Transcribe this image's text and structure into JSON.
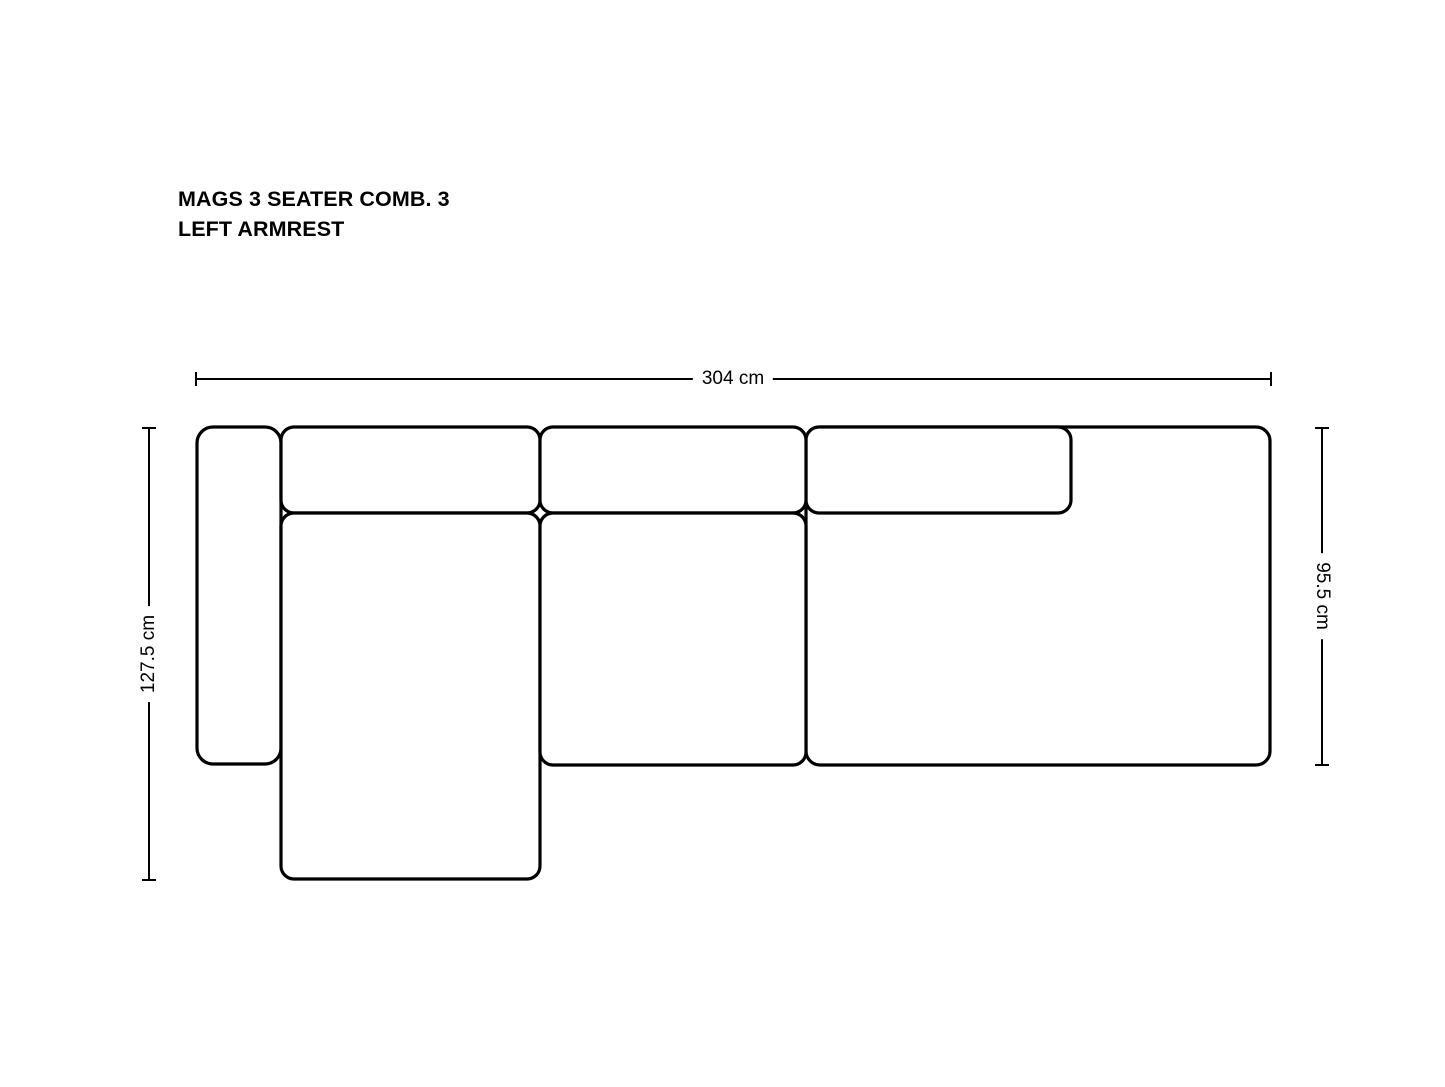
{
  "title": {
    "line1": "MAGS 3 SEATER COMB. 3",
    "line2": "LEFT ARMREST"
  },
  "dimensions": {
    "width": {
      "label": "304 cm",
      "value_cm": 304
    },
    "height_left": {
      "label": "127.5 cm",
      "value_cm": 127.5
    },
    "depth_right": {
      "label": "95.5 cm",
      "value_cm": 95.5
    }
  },
  "colors": {
    "line": "#000000",
    "text": "#000000",
    "background": "#ffffff"
  },
  "diagram": {
    "module_stroke_width": 3.2,
    "dim_stroke_width": 2,
    "modules": [
      {
        "name": "right-seat-module",
        "x": 806,
        "y": 427,
        "w": 464,
        "h": 338,
        "r": 14
      },
      {
        "name": "backrest-cushion-right",
        "x": 806,
        "y": 427,
        "w": 265,
        "h": 86,
        "r": 13
      },
      {
        "name": "left-armrest",
        "x": 197,
        "y": 427,
        "w": 84,
        "h": 337,
        "r": 16
      },
      {
        "name": "backrest-cushion-left",
        "x": 281,
        "y": 427,
        "w": 259,
        "h": 86,
        "r": 13
      },
      {
        "name": "backrest-cushion-middle",
        "x": 540,
        "y": 427,
        "w": 266,
        "h": 86,
        "r": 13
      },
      {
        "name": "chaise-lounge-seat",
        "x": 281,
        "y": 513,
        "w": 259,
        "h": 366,
        "r": 13
      },
      {
        "name": "middle-seat",
        "x": 540,
        "y": 513,
        "w": 266,
        "h": 252,
        "r": 13
      }
    ],
    "dimension_lines": [
      {
        "name": "width-dimension-line",
        "x1": 196,
        "y1": 379,
        "x2": 1271,
        "y2": 379,
        "tick": 14
      },
      {
        "name": "height-dimension-line",
        "x1": 149,
        "y1": 428,
        "x2": 149,
        "y2": 880,
        "tick": 14
      },
      {
        "name": "depth-dimension-line",
        "x1": 1322,
        "y1": 428,
        "x2": 1322,
        "y2": 765,
        "tick": 14
      }
    ]
  }
}
